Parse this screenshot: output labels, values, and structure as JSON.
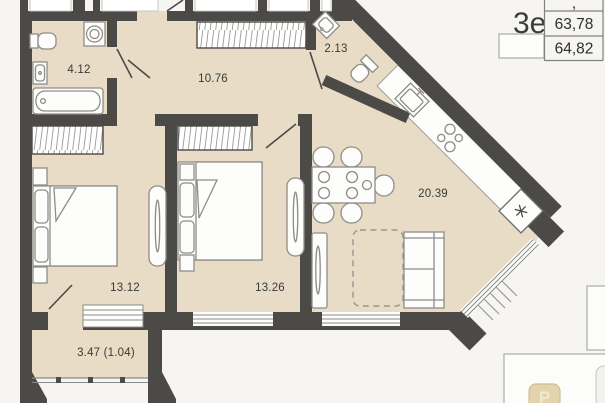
{
  "rooms": {
    "bathroom": {
      "name": "bathroom",
      "area": "4.12"
    },
    "hallway": {
      "name": "hallway",
      "area": "10.76"
    },
    "wc": {
      "name": "wc",
      "area": "2.13"
    },
    "living_kitchen": {
      "name": "living-kitchen",
      "area": "20.39"
    },
    "bedroom_1": {
      "name": "bedroom-1",
      "area": "13.12"
    },
    "bedroom_2": {
      "name": "bedroom-2",
      "area": "13.26"
    },
    "balcony": {
      "name": "balcony",
      "area": "3.47 (1.04)"
    }
  },
  "title_block": {
    "unit_label": "3е",
    "partial_top_row": ",",
    "rows": [
      "63,78",
      "64,82"
    ]
  },
  "watermark": {
    "letter": "Р"
  },
  "icons": {
    "refrigerator": "✳"
  },
  "colors": {
    "wall": "#4b4a47",
    "floor": "#e8dcc7",
    "furniture_outline": "#8e8d89",
    "furniture_fill": "#fdfdfc",
    "background": "#f6f5f2",
    "watermark_badge": "#e3d4ad"
  }
}
